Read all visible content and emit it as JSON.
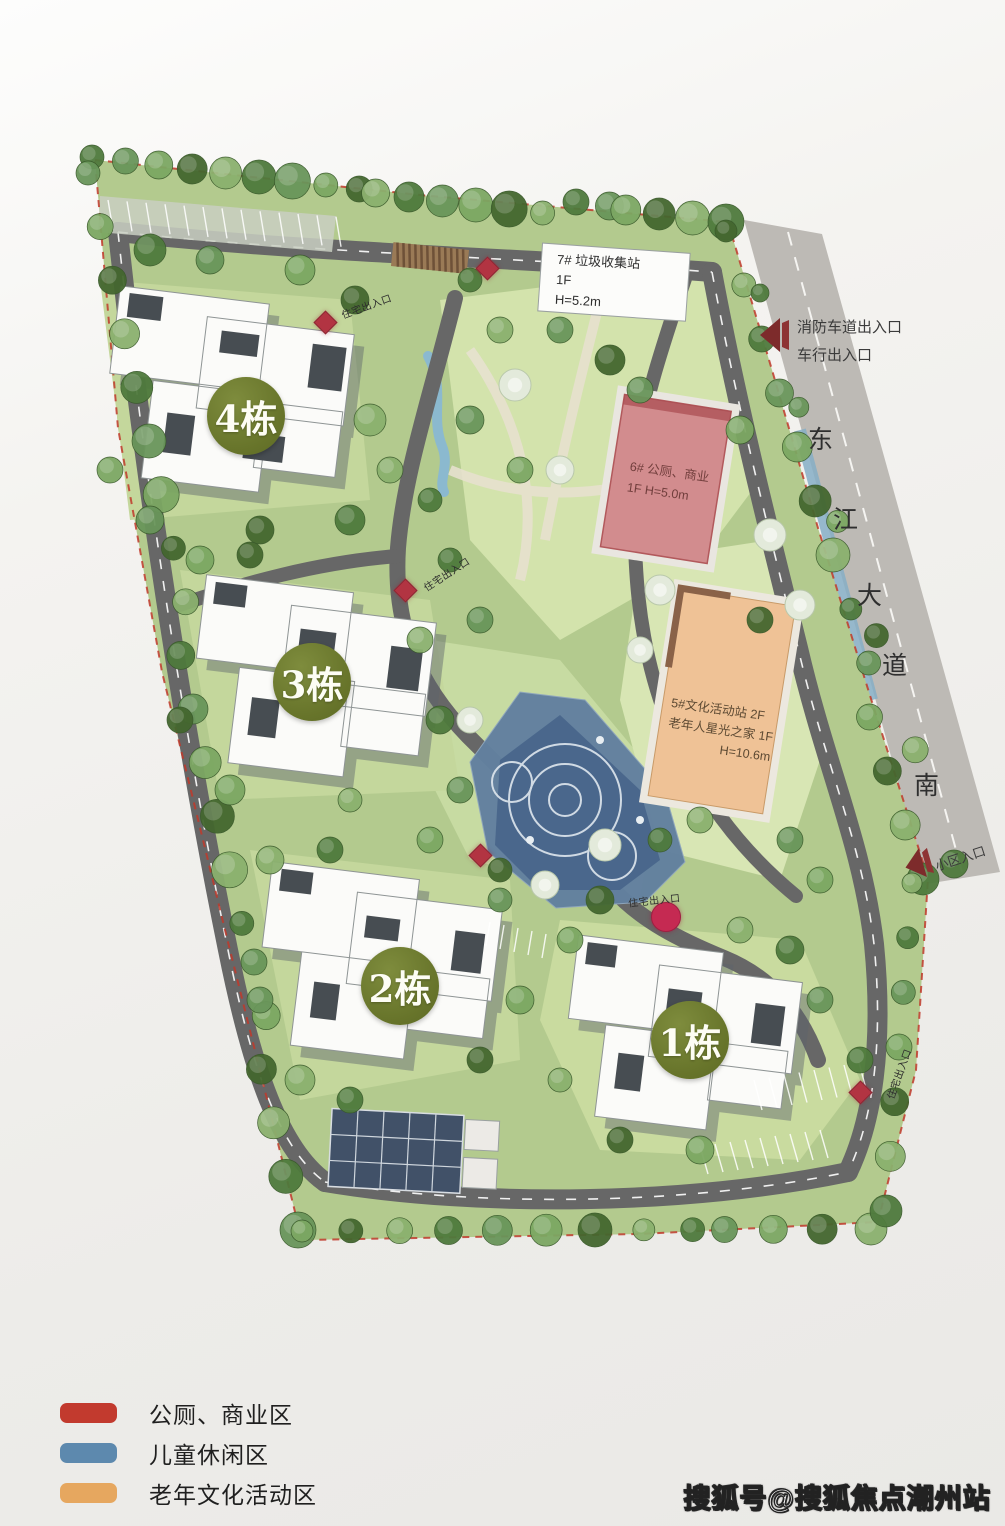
{
  "map": {
    "buildings": [
      {
        "id": "1",
        "label": "1栋"
      },
      {
        "id": "2",
        "label": "2栋"
      },
      {
        "id": "3",
        "label": "3栋"
      },
      {
        "id": "4",
        "label": "4栋"
      }
    ],
    "facilities": {
      "garbage_station": {
        "line1": "7# 垃圾收集站",
        "line2": "1F",
        "line3": "H=5.2m"
      },
      "commercial": {
        "line1": "6# 公厕、商业",
        "line2": "1F  H=5.0m"
      },
      "culture": {
        "line1": "5#文化活动站 2F",
        "line2": "老年人星光之家 1F",
        "line3": "H=10.6m"
      }
    },
    "entrances": {
      "fire_lane": "消防车道出入口",
      "vehicle": "车行出入口",
      "community": "小区入口",
      "residential": "住宅出入口"
    },
    "road_name": {
      "chars": [
        "东",
        "江",
        "大",
        "道",
        "南"
      ]
    }
  },
  "legend": {
    "items": [
      {
        "color": "#c23a2e",
        "label": "公厕、商业区"
      },
      {
        "color": "#5d89ae",
        "label": "儿童休闲区"
      },
      {
        "color": "#e6a75f",
        "label": "老年文化活动区"
      }
    ]
  },
  "watermark": {
    "text": "搜狐号@搜狐焦点潮州站"
  },
  "colors": {
    "site_boundary": "#c0392b",
    "building_badge": "#6e7b2e"
  }
}
